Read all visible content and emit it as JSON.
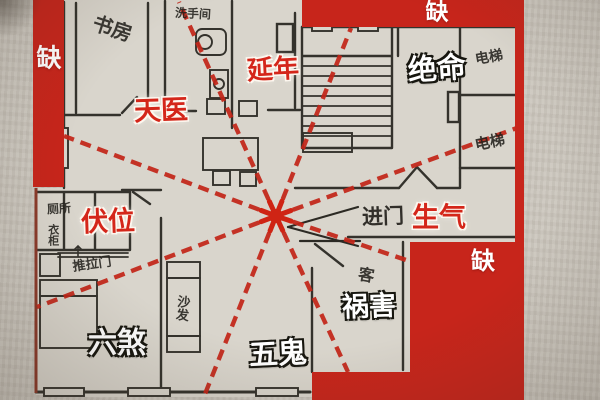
{
  "palette": {
    "red_block": "#c7251b",
    "dash_red": "#c32619",
    "paper_margin": "#cbc6bd",
    "plan_paper": "#d9d5cc",
    "wall_ink": "#34322c",
    "handwriting_ink": "#24221d",
    "position_label_red": "#d4261a",
    "position_label_white": "#ffffff"
  },
  "labels": {
    "positions": [
      {
        "id": "tianyi",
        "text": "天医",
        "style": "red",
        "x": 161,
        "y": 111,
        "size": 27,
        "rot": -2
      },
      {
        "id": "yannian",
        "text": "延年",
        "style": "red",
        "x": 273,
        "y": 69,
        "size": 26,
        "rot": -3
      },
      {
        "id": "juemin",
        "text": "绝命",
        "style": "white",
        "x": 437,
        "y": 70,
        "size": 29,
        "rot": -4
      },
      {
        "id": "fuwei",
        "text": "伏位",
        "style": "red",
        "x": 108,
        "y": 222,
        "size": 27,
        "rot": -2
      },
      {
        "id": "shengqi",
        "text": "生气",
        "style": "red",
        "x": 439,
        "y": 218,
        "size": 27,
        "rot": 0
      },
      {
        "id": "huohai",
        "text": "祸害",
        "style": "white",
        "x": 369,
        "y": 307,
        "size": 27,
        "rot": -2
      },
      {
        "id": "wugui",
        "text": "五鬼",
        "style": "white",
        "x": 278,
        "y": 355,
        "size": 29,
        "rot": -3
      },
      {
        "id": "liusha",
        "text": "六煞",
        "style": "white",
        "x": 117,
        "y": 344,
        "size": 29,
        "rot": 0
      },
      {
        "id": "jinmen",
        "text": "进门",
        "style": "hand-large",
        "x": 383,
        "y": 217,
        "size": 21,
        "rot": -2
      },
      {
        "id": "que-left",
        "text": "缺",
        "style": "badge",
        "x": 49,
        "y": 59,
        "size": 25,
        "rot": 0
      },
      {
        "id": "que-top",
        "text": "缺",
        "style": "badge",
        "x": 437,
        "y": 12,
        "size": 23,
        "rot": 0
      },
      {
        "id": "que-bottom-right",
        "text": "缺",
        "style": "badge",
        "x": 483,
        "y": 262,
        "size": 24,
        "rot": 0
      }
    ],
    "rooms": [
      {
        "id": "study",
        "text": "书房",
        "x": 112,
        "y": 30,
        "size": 20,
        "rot": 18,
        "vertical": false
      },
      {
        "id": "washroom",
        "text": "洗手间",
        "x": 193,
        "y": 14,
        "size": 12,
        "rot": 3,
        "vertical": false
      },
      {
        "id": "elevator-1",
        "text": "电梯",
        "x": 489,
        "y": 57,
        "size": 14,
        "rot": -10,
        "vertical": false
      },
      {
        "id": "elevator-2",
        "text": "电梯",
        "x": 490,
        "y": 143,
        "size": 15,
        "rot": -12,
        "vertical": false
      },
      {
        "id": "toilet",
        "text": "厕所",
        "x": 59,
        "y": 209,
        "size": 12,
        "rot": -4,
        "vertical": false
      },
      {
        "id": "wardrobe",
        "text": "衣柜",
        "x": 52,
        "y": 235,
        "size": 11,
        "rot": 0,
        "vertical": true
      },
      {
        "id": "sliding-door",
        "text": "推拉门",
        "x": 92,
        "y": 264,
        "size": 13,
        "rot": -8,
        "vertical": false
      },
      {
        "id": "sofa",
        "text": "沙发",
        "x": 182,
        "y": 308,
        "size": 13,
        "rot": 6,
        "vertical": true
      },
      {
        "id": "living-room",
        "text": "客",
        "x": 366,
        "y": 277,
        "size": 16,
        "rot": 10,
        "vertical": false
      }
    ]
  },
  "compass": {
    "center": {
      "x": 276,
      "y": 216
    },
    "rays": [
      {
        "x": 64,
        "y": 136
      },
      {
        "x": 179,
        "y": 2
      },
      {
        "x": 351,
        "y": 28
      },
      {
        "x": 517,
        "y": 128
      },
      {
        "x": 412,
        "y": 262
      },
      {
        "x": 348,
        "y": 372
      },
      {
        "x": 203,
        "y": 399
      },
      {
        "x": 37,
        "y": 307
      }
    ]
  }
}
